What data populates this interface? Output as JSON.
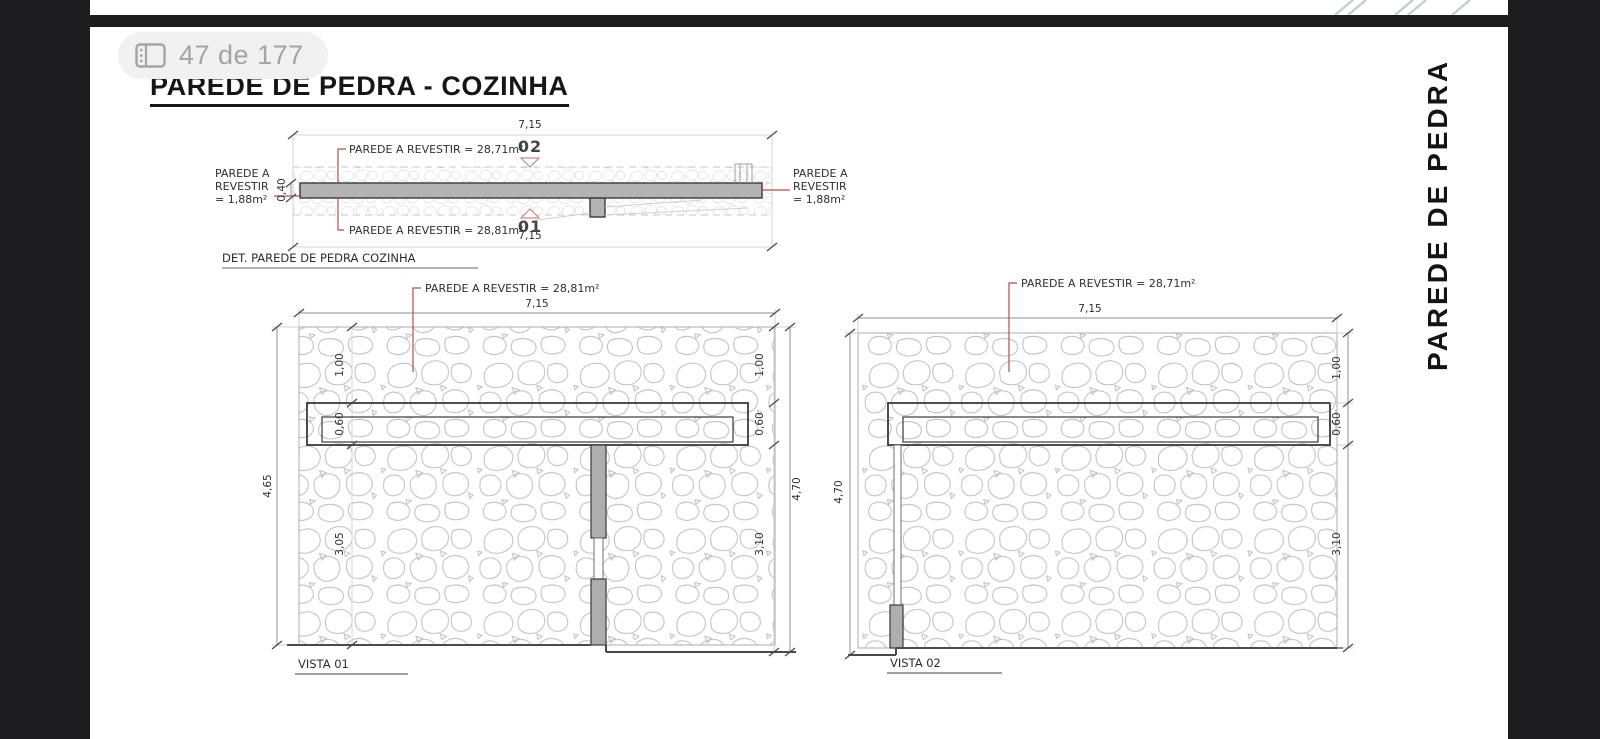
{
  "viewer": {
    "page_indicator": "47 de 177"
  },
  "doc": {
    "title": "PAREDE DE PEDRA - COZINHA",
    "side_label": "PAREDE DE PEDRA"
  },
  "colors": {
    "accent": "#b0514a",
    "triangle_outline": "#c98d82",
    "wall_fill": "#b3b3b3",
    "column_fill": "#aeaeae",
    "chrome_bg": "#1d1d20"
  },
  "plan": {
    "caption": "DET. PAREDE DE PEDRA COZINHA",
    "dim_width_top": "7,15",
    "dim_width_bottom": "7,15",
    "dim_thickness": "0,40",
    "marker_top": "02",
    "marker_bottom": "01",
    "label_top": "PAREDE A REVESTIR = 28,71m²",
    "label_bottom": "PAREDE A REVESTIR = 28,81m²",
    "label_left": [
      "PAREDE A",
      "REVESTIR",
      "= 1,88m²"
    ],
    "label_right": [
      "PAREDE A",
      "REVESTIR",
      "= 1,88m²"
    ]
  },
  "vista01": {
    "caption": "VISTA 01",
    "label": "PAREDE A REVESTIR = 28,81m²",
    "dim_width": "7,15",
    "dim_height_left": "4,65",
    "dim_height_right": "4,70",
    "dim_upper_left": "1,00",
    "dim_upper_right": "1,00",
    "dim_niche_left": "0,60",
    "dim_niche_right": "0,60",
    "dim_lower_left": "3,05",
    "dim_lower_right": "3,10"
  },
  "vista02": {
    "caption": "VISTA 02",
    "label": "PAREDE A REVESTIR = 28,71m²",
    "dim_width": "7,15",
    "dim_height_left": "4,70",
    "dim_upper_right": "1,00",
    "dim_niche_right": "0,60",
    "dim_lower_right": "3,10"
  }
}
